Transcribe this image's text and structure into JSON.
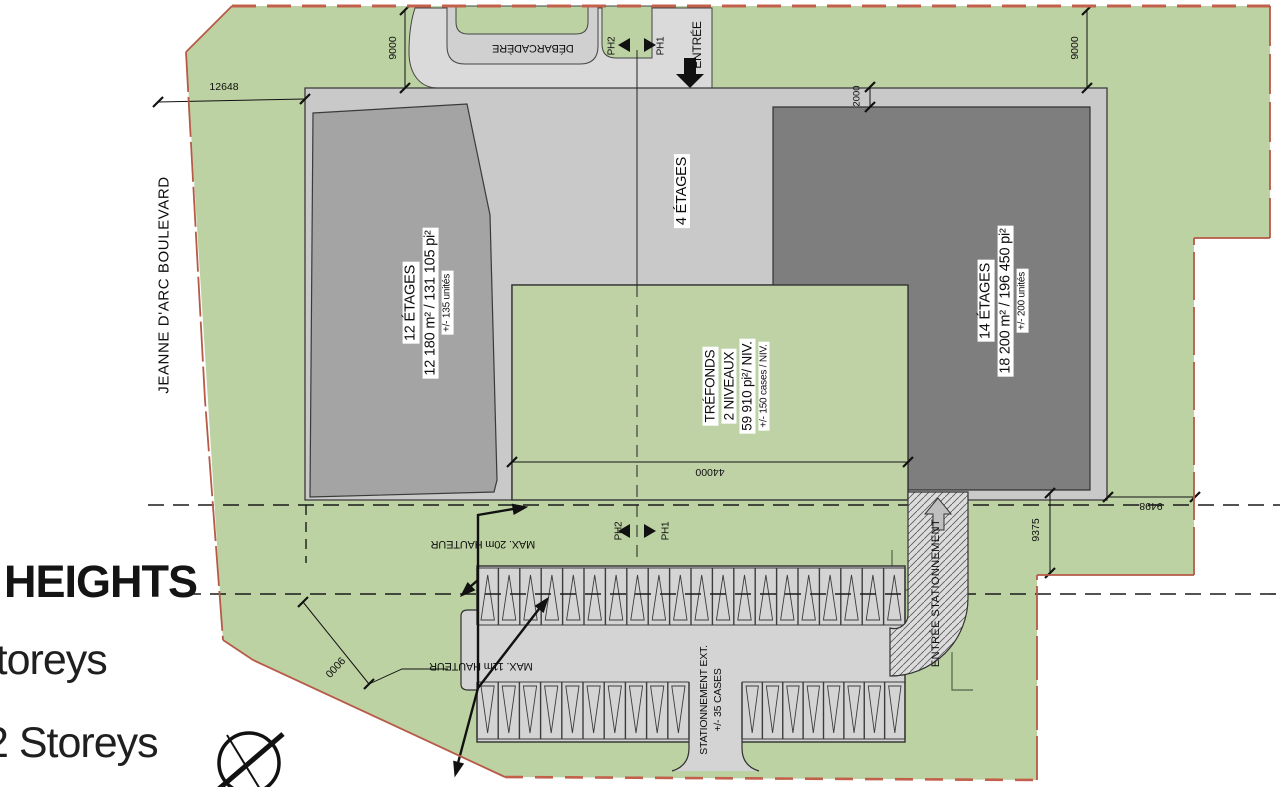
{
  "site": {
    "road_label": "JEANNE D'ARC BOULEVARD",
    "entrance_label": "ENTRÉE",
    "dropoff_label": "DÉBARCADÈRE",
    "parking_entrance_label": "ENTRÉE STATIONNEMENT",
    "phase_left": "PH2",
    "phase_right": "PH1",
    "colors": {
      "site_green": "#bdd2a3",
      "podium_gray": "#c9c9c9",
      "west_building_gray": "#a4a4a4",
      "east_tower_gray": "#7e7e7e",
      "pavement_gray": "#d8d8d8",
      "boundary_red": "#b65a47"
    }
  },
  "buildings": {
    "west": {
      "storeys": "12 ÉTAGES",
      "area": "12 180 m² / 131 105 pi²",
      "units": "+/- 135 unités"
    },
    "podium": {
      "storeys": "4 ÉTAGES"
    },
    "east": {
      "storeys": "14 ÉTAGES",
      "area": "18 200 m² / 196 450 pi²",
      "units": "+/- 200 unités"
    },
    "underground": {
      "name": "TRÉFONDS",
      "levels": "2 NIVEAUX",
      "area": "59 910 pi²/ NIV.",
      "spaces": "+/- 150 cases / NIV."
    }
  },
  "height_limits": {
    "zone20": "MAX. 20m HAUTEUR",
    "zone11": "MAX. 11m HAUTEUR"
  },
  "parking": {
    "label_line1": "STATIONNEMENT EXT.",
    "label_line2": "+/- 35 CASES",
    "top_row_stalls": 20,
    "bottom_left_stalls": 10,
    "bottom_right_stalls": 8
  },
  "dimensions": {
    "west_setback": "12648",
    "north_setback_west": "9000",
    "north_setback_east": "9000",
    "tower_inset": "2000",
    "underground_width": "44000",
    "south_setback_east": "9375",
    "east_setback": "9498",
    "southwest_setback": "9000"
  },
  "legend": {
    "title": "HEIGHTS",
    "item_top": "Storeys",
    "item_bottom": "2 Storeys"
  }
}
